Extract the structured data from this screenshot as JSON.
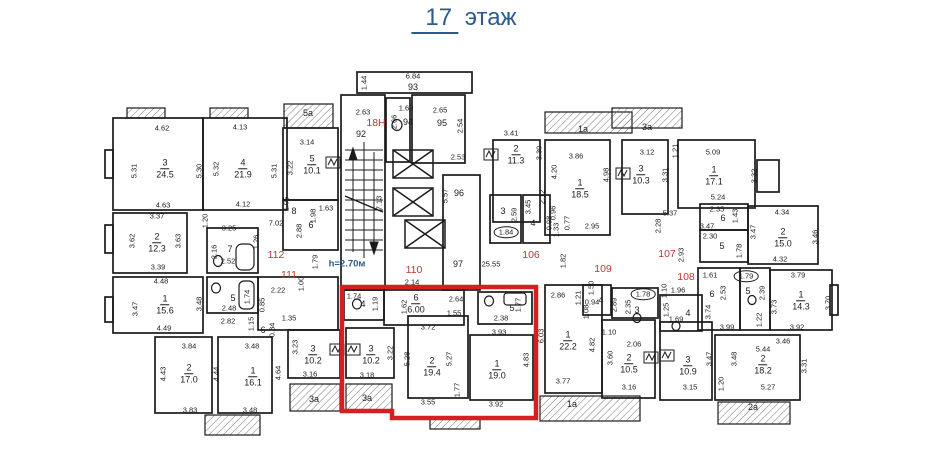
{
  "title": {
    "floor_number": "17",
    "floor_word": "этаж"
  },
  "colors": {
    "wall": "#1b1b1b",
    "highlight_red": "#d42020",
    "unit_red": "#c03434",
    "blue": "#2b5a8c"
  },
  "plan": {
    "note_labels": [
      {
        "t": "h=2.70м",
        "x": 347,
        "y": 264
      }
    ],
    "unit_labels": [
      {
        "t": "18Н",
        "x": 376,
        "y": 123
      },
      {
        "t": "110",
        "x": 414,
        "y": 270
      },
      {
        "t": "111",
        "x": 289,
        "y": 275
      },
      {
        "t": "112",
        "x": 276,
        "y": 255
      },
      {
        "t": "106",
        "x": 531,
        "y": 255
      },
      {
        "t": "107",
        "x": 667,
        "y": 254
      },
      {
        "t": "108",
        "x": 686,
        "y": 277
      },
      {
        "t": "109",
        "x": 603,
        "y": 269
      }
    ],
    "room_labels": [
      {
        "n": "3",
        "a": "24.5",
        "x": 165,
        "y": 166
      },
      {
        "n": "4",
        "a": "21.9",
        "x": 243,
        "y": 166
      },
      {
        "n": "2",
        "a": "12.3",
        "x": 157,
        "y": 240
      },
      {
        "n": "7",
        "x": 230,
        "y": 248
      },
      {
        "n": "1",
        "a": "15.6",
        "x": 165,
        "y": 302
      },
      {
        "n": "5",
        "x": 233,
        "y": 297
      },
      {
        "n": "2",
        "a": "17.0",
        "x": 189,
        "y": 371
      },
      {
        "n": "1",
        "a": "16.1",
        "x": 253,
        "y": 374
      },
      {
        "n": "5a",
        "x": 308,
        "y": 112
      },
      {
        "n": "5",
        "a": "10.1",
        "x": 312,
        "y": 162
      },
      {
        "n": "8",
        "x": 294,
        "y": 210
      },
      {
        "n": "6",
        "x": 311,
        "y": 224
      },
      {
        "n": "6",
        "x": 263,
        "y": 329
      },
      {
        "n": "92",
        "x": 361,
        "y": 133
      },
      {
        "n": "93",
        "x": 413,
        "y": 86
      },
      {
        "n": "94",
        "x": 408,
        "y": 121
      },
      {
        "n": "95",
        "x": 442,
        "y": 122
      },
      {
        "n": "96",
        "x": 459,
        "y": 192
      },
      {
        "n": "97",
        "x": 458,
        "y": 263
      },
      {
        "n": "4",
        "x": 363,
        "y": 303
      },
      {
        "n": "6",
        "a": "6.00",
        "x": 416,
        "y": 301
      },
      {
        "n": "5",
        "x": 512,
        "y": 307
      },
      {
        "n": "3",
        "a": "10.2",
        "x": 371,
        "y": 352
      },
      {
        "n": "2",
        "a": "19.4",
        "x": 432,
        "y": 364
      },
      {
        "n": "1",
        "a": "19.0",
        "x": 497,
        "y": 367
      },
      {
        "n": "3",
        "a": "10.2",
        "x": 313,
        "y": 352
      },
      {
        "n": "3a",
        "x": 314,
        "y": 398
      },
      {
        "n": "3a",
        "x": 367,
        "y": 397
      },
      {
        "n": "2",
        "a": "11.3",
        "x": 516,
        "y": 152
      },
      {
        "n": "3",
        "x": 503,
        "y": 210
      },
      {
        "n": "4",
        "x": 533,
        "y": 222
      },
      {
        "n": "1",
        "a": "18.5",
        "x": 580,
        "y": 186
      },
      {
        "n": "1",
        "a": "22.2",
        "x": 568,
        "y": 338
      },
      {
        "n": "4",
        "x": 601,
        "y": 299
      },
      {
        "n": "3",
        "x": 637,
        "y": 309
      },
      {
        "n": "2",
        "a": "10.5",
        "x": 629,
        "y": 361
      },
      {
        "n": "1a",
        "x": 572,
        "y": 403
      },
      {
        "n": "3",
        "a": "10.3",
        "x": 641,
        "y": 172
      },
      {
        "n": "1",
        "a": "17.1",
        "x": 714,
        "y": 173
      },
      {
        "n": "2",
        "a": "15.0",
        "x": 783,
        "y": 235
      },
      {
        "n": "6",
        "x": 723,
        "y": 217
      },
      {
        "n": "5",
        "x": 722,
        "y": 245
      },
      {
        "n": "4",
        "x": 688,
        "y": 312
      },
      {
        "n": "6",
        "x": 712,
        "y": 293
      },
      {
        "n": "5",
        "x": 748,
        "y": 290
      },
      {
        "n": "1",
        "a": "14.3",
        "x": 801,
        "y": 298
      },
      {
        "n": "2",
        "a": "18.2",
        "x": 763,
        "y": 362
      },
      {
        "n": "3",
        "a": "10.9",
        "x": 688,
        "y": 363
      },
      {
        "n": "2a",
        "x": 753,
        "y": 406
      },
      {
        "n": "1a",
        "x": 583,
        "y": 128
      },
      {
        "n": "3a",
        "x": 647,
        "y": 126
      }
    ],
    "dim_labels": [
      {
        "t": "4.62",
        "x": 162,
        "y": 128
      },
      {
        "t": "4.13",
        "x": 240,
        "y": 127
      },
      {
        "t": "5.31",
        "x": 134,
        "y": 171,
        "v": 1
      },
      {
        "t": "5.30",
        "x": 199,
        "y": 171,
        "v": 1
      },
      {
        "t": "5.32",
        "x": 216,
        "y": 169,
        "v": 1
      },
      {
        "t": "5.31",
        "x": 274,
        "y": 171,
        "v": 1
      },
      {
        "t": "3.22",
        "x": 290,
        "y": 168,
        "v": 1
      },
      {
        "t": "4.63",
        "x": 163,
        "y": 205
      },
      {
        "t": "4.12",
        "x": 243,
        "y": 204
      },
      {
        "t": "1.05",
        "x": 286,
        "y": 204,
        "v": 1
      },
      {
        "t": "3.37",
        "x": 157,
        "y": 216
      },
      {
        "t": "7.02",
        "x": 276,
        "y": 223
      },
      {
        "t": "3.25",
        "x": 229,
        "y": 228
      },
      {
        "t": "1.20",
        "x": 205,
        "y": 221,
        "v": 1
      },
      {
        "t": "3.62",
        "x": 132,
        "y": 241,
        "v": 1
      },
      {
        "t": "3.63",
        "x": 178,
        "y": 241,
        "v": 1
      },
      {
        "t": "1.26",
        "x": 256,
        "y": 242,
        "v": 1
      },
      {
        "t": "2.16",
        "x": 214,
        "y": 252,
        "v": 1
      },
      {
        "t": "2.52",
        "x": 228,
        "y": 261
      },
      {
        "t": "3.39",
        "x": 158,
        "y": 267
      },
      {
        "t": "4.48",
        "x": 161,
        "y": 281
      },
      {
        "t": "3.47",
        "x": 135,
        "y": 309,
        "v": 1
      },
      {
        "t": "3.48",
        "x": 199,
        "y": 304,
        "v": 1
      },
      {
        "t": "4.49",
        "x": 164,
        "y": 328
      },
      {
        "t": "2.48",
        "x": 229,
        "y": 308
      },
      {
        "t": "1.74",
        "x": 247,
        "y": 297,
        "v": 1
      },
      {
        "t": "0.85",
        "x": 262,
        "y": 305,
        "v": 1
      },
      {
        "t": "2.82",
        "x": 228,
        "y": 321
      },
      {
        "t": "1.15",
        "x": 251,
        "y": 324,
        "v": 1
      },
      {
        "t": "2.22",
        "x": 278,
        "y": 290
      },
      {
        "t": "1.00",
        "x": 301,
        "y": 284,
        "v": 1
      },
      {
        "t": "1.79",
        "x": 315,
        "y": 262,
        "v": 1
      },
      {
        "t": "1.35",
        "x": 289,
        "y": 318
      },
      {
        "t": "0.84",
        "x": 272,
        "y": 330,
        "v": 1
      },
      {
        "t": "3.23",
        "x": 295,
        "y": 347,
        "v": 1
      },
      {
        "t": "3.84",
        "x": 189,
        "y": 346
      },
      {
        "t": "4.43",
        "x": 163,
        "y": 374,
        "v": 1
      },
      {
        "t": "4.44",
        "x": 216,
        "y": 374,
        "v": 1
      },
      {
        "t": "3.83",
        "x": 190,
        "y": 410
      },
      {
        "t": "3.48",
        "x": 252,
        "y": 346
      },
      {
        "t": "4.64",
        "x": 278,
        "y": 373,
        "v": 1
      },
      {
        "t": "3.48",
        "x": 250,
        "y": 410
      },
      {
        "t": "3.14",
        "x": 307,
        "y": 142
      },
      {
        "t": "1.63",
        "x": 326,
        "y": 208
      },
      {
        "t": "1.98",
        "x": 313,
        "y": 216,
        "v": 1
      },
      {
        "t": "2.88",
        "x": 299,
        "y": 231,
        "v": 1
      },
      {
        "t": "1.44",
        "x": 364,
        "y": 83,
        "v": 1
      },
      {
        "t": "6.84",
        "x": 413,
        "y": 76
      },
      {
        "t": "2.63",
        "x": 363,
        "y": 112
      },
      {
        "t": "1.69",
        "x": 406,
        "y": 108
      },
      {
        "t": "2.66",
        "x": 394,
        "y": 122,
        "v": 1
      },
      {
        "t": "2.65",
        "x": 440,
        "y": 110
      },
      {
        "t": "2.54",
        "x": 460,
        "y": 126,
        "v": 1
      },
      {
        "t": "2.53",
        "x": 458,
        "y": 157
      },
      {
        "t": "5.57",
        "x": 445,
        "y": 196,
        "v": 1
      },
      {
        "t": "7.13",
        "x": 379,
        "y": 203,
        "v": 1
      },
      {
        "t": "25.55",
        "x": 491,
        "y": 264
      },
      {
        "t": "2.14",
        "x": 412,
        "y": 282
      },
      {
        "t": "1.82",
        "x": 563,
        "y": 261,
        "v": 1
      },
      {
        "t": "1.74",
        "x": 354,
        "y": 296
      },
      {
        "t": "1.19",
        "x": 375,
        "y": 304,
        "v": 1
      },
      {
        "t": "1.62",
        "x": 404,
        "y": 307,
        "v": 1
      },
      {
        "t": "2.64",
        "x": 456,
        "y": 299
      },
      {
        "t": "1.55",
        "x": 454,
        "y": 313
      },
      {
        "t": "2.38",
        "x": 501,
        "y": 318
      },
      {
        "t": "1.77",
        "x": 518,
        "y": 305,
        "v": 1
      },
      {
        "t": "3.72",
        "x": 428,
        "y": 327
      },
      {
        "t": "3.93",
        "x": 499,
        "y": 332
      },
      {
        "t": "3.22",
        "x": 390,
        "y": 353,
        "v": 1
      },
      {
        "t": "5.28",
        "x": 407,
        "y": 359,
        "v": 1
      },
      {
        "t": "5.27",
        "x": 449,
        "y": 359,
        "v": 1
      },
      {
        "t": "4.83",
        "x": 526,
        "y": 360,
        "v": 1
      },
      {
        "t": "6.03",
        "x": 541,
        "y": 336,
        "v": 1
      },
      {
        "t": "3.18",
        "x": 367,
        "y": 375
      },
      {
        "t": "3.16",
        "x": 310,
        "y": 374
      },
      {
        "t": "3.55",
        "x": 428,
        "y": 402
      },
      {
        "t": "1.77",
        "x": 457,
        "y": 390,
        "v": 1
      },
      {
        "t": "3.92",
        "x": 496,
        "y": 404
      },
      {
        "t": "3.41",
        "x": 511,
        "y": 133
      },
      {
        "t": "3.30",
        "x": 539,
        "y": 153,
        "v": 1
      },
      {
        "t": "3.86",
        "x": 576,
        "y": 156
      },
      {
        "t": "4.20",
        "x": 554,
        "y": 172,
        "v": 1
      },
      {
        "t": "4.98",
        "x": 606,
        "y": 175,
        "v": 1
      },
      {
        "t": "2.95",
        "x": 592,
        "y": 226
      },
      {
        "t": "0.77",
        "x": 567,
        "y": 223,
        "v": 1
      },
      {
        "t": "0.96",
        "x": 553,
        "y": 213,
        "v": 1
      },
      {
        "t": "0.98",
        "x": 549,
        "y": 223,
        "v": 1
      },
      {
        "t": "1.33",
        "x": 556,
        "y": 230,
        "v": 1
      },
      {
        "t": "2.12",
        "x": 542,
        "y": 197,
        "v": 1
      },
      {
        "t": "3.45",
        "x": 528,
        "y": 207,
        "v": 1
      },
      {
        "t": "2.59",
        "x": 514,
        "y": 215,
        "v": 1
      },
      {
        "t": "1.84",
        "x": 506,
        "y": 232,
        "o": 1
      },
      {
        "t": "2.86",
        "x": 558,
        "y": 295
      },
      {
        "t": "1.21",
        "x": 578,
        "y": 298,
        "v": 1
      },
      {
        "t": "1.50",
        "x": 591,
        "y": 288,
        "v": 1
      },
      {
        "t": "0.94",
        "x": 592,
        "y": 302
      },
      {
        "t": "1.08",
        "x": 586,
        "y": 312,
        "v": 1
      },
      {
        "t": "2.89",
        "x": 614,
        "y": 305,
        "v": 1
      },
      {
        "t": "4.82",
        "x": 592,
        "y": 345,
        "v": 1
      },
      {
        "t": "3.77",
        "x": 563,
        "y": 381
      },
      {
        "t": "3.60",
        "x": 610,
        "y": 358,
        "v": 1
      },
      {
        "t": "3.16",
        "x": 629,
        "y": 387
      },
      {
        "t": "2.06",
        "x": 634,
        "y": 344
      },
      {
        "t": "1.10",
        "x": 609,
        "y": 332
      },
      {
        "t": "2.35",
        "x": 628,
        "y": 307,
        "v": 1
      },
      {
        "t": "1.78",
        "x": 643,
        "y": 294,
        "o": 1
      },
      {
        "t": "1.10",
        "x": 664,
        "y": 291,
        "v": 1
      },
      {
        "t": "1.96",
        "x": 678,
        "y": 290
      },
      {
        "t": "1.25",
        "x": 666,
        "y": 310,
        "v": 1
      },
      {
        "t": "1.69",
        "x": 676,
        "y": 319
      },
      {
        "t": "3.74",
        "x": 708,
        "y": 312,
        "v": 1
      },
      {
        "t": "3.12",
        "x": 647,
        "y": 152
      },
      {
        "t": "3.31",
        "x": 665,
        "y": 175,
        "v": 1
      },
      {
        "t": "1.21",
        "x": 675,
        "y": 151,
        "v": 1
      },
      {
        "t": "5.09",
        "x": 713,
        "y": 152
      },
      {
        "t": "3.32",
        "x": 754,
        "y": 176,
        "v": 1
      },
      {
        "t": "5.24",
        "x": 718,
        "y": 197
      },
      {
        "t": "2.35",
        "x": 717,
        "y": 209
      },
      {
        "t": "1.43",
        "x": 735,
        "y": 216,
        "v": 1
      },
      {
        "t": "3.47",
        "x": 707,
        "y": 226
      },
      {
        "t": "5.37",
        "x": 670,
        "y": 213
      },
      {
        "t": "2.28",
        "x": 658,
        "y": 226,
        "v": 1
      },
      {
        "t": "2.93",
        "x": 681,
        "y": 255,
        "v": 1
      },
      {
        "t": "4.34",
        "x": 782,
        "y": 212
      },
      {
        "t": "3.47",
        "x": 753,
        "y": 232,
        "v": 1
      },
      {
        "t": "3.46",
        "x": 815,
        "y": 237,
        "v": 1
      },
      {
        "t": "4.32",
        "x": 780,
        "y": 259
      },
      {
        "t": "2.30",
        "x": 710,
        "y": 236
      },
      {
        "t": "1.78",
        "x": 739,
        "y": 251,
        "v": 1
      },
      {
        "t": "1.61",
        "x": 710,
        "y": 275
      },
      {
        "t": "1.79",
        "x": 746,
        "y": 276,
        "o": 1
      },
      {
        "t": "3.79",
        "x": 798,
        "y": 275
      },
      {
        "t": "2.53",
        "x": 723,
        "y": 293,
        "v": 1
      },
      {
        "t": "2.39",
        "x": 762,
        "y": 293,
        "v": 1
      },
      {
        "t": "1.22",
        "x": 759,
        "y": 320,
        "v": 1
      },
      {
        "t": "3.73",
        "x": 774,
        "y": 307,
        "v": 1
      },
      {
        "t": "3.70",
        "x": 828,
        "y": 303,
        "v": 1
      },
      {
        "t": "3.99",
        "x": 727,
        "y": 327
      },
      {
        "t": "3.92",
        "x": 797,
        "y": 327
      },
      {
        "t": "3.46",
        "x": 783,
        "y": 341
      },
      {
        "t": "5.44",
        "x": 763,
        "y": 349
      },
      {
        "t": "3.48",
        "x": 734,
        "y": 359,
        "v": 1
      },
      {
        "t": "3.47",
        "x": 709,
        "y": 359,
        "v": 1
      },
      {
        "t": "3.31",
        "x": 804,
        "y": 366,
        "v": 1
      },
      {
        "t": "5.27",
        "x": 768,
        "y": 387
      },
      {
        "t": "1.20",
        "x": 721,
        "y": 384,
        "v": 1
      },
      {
        "t": "3.15",
        "x": 690,
        "y": 387
      }
    ]
  }
}
